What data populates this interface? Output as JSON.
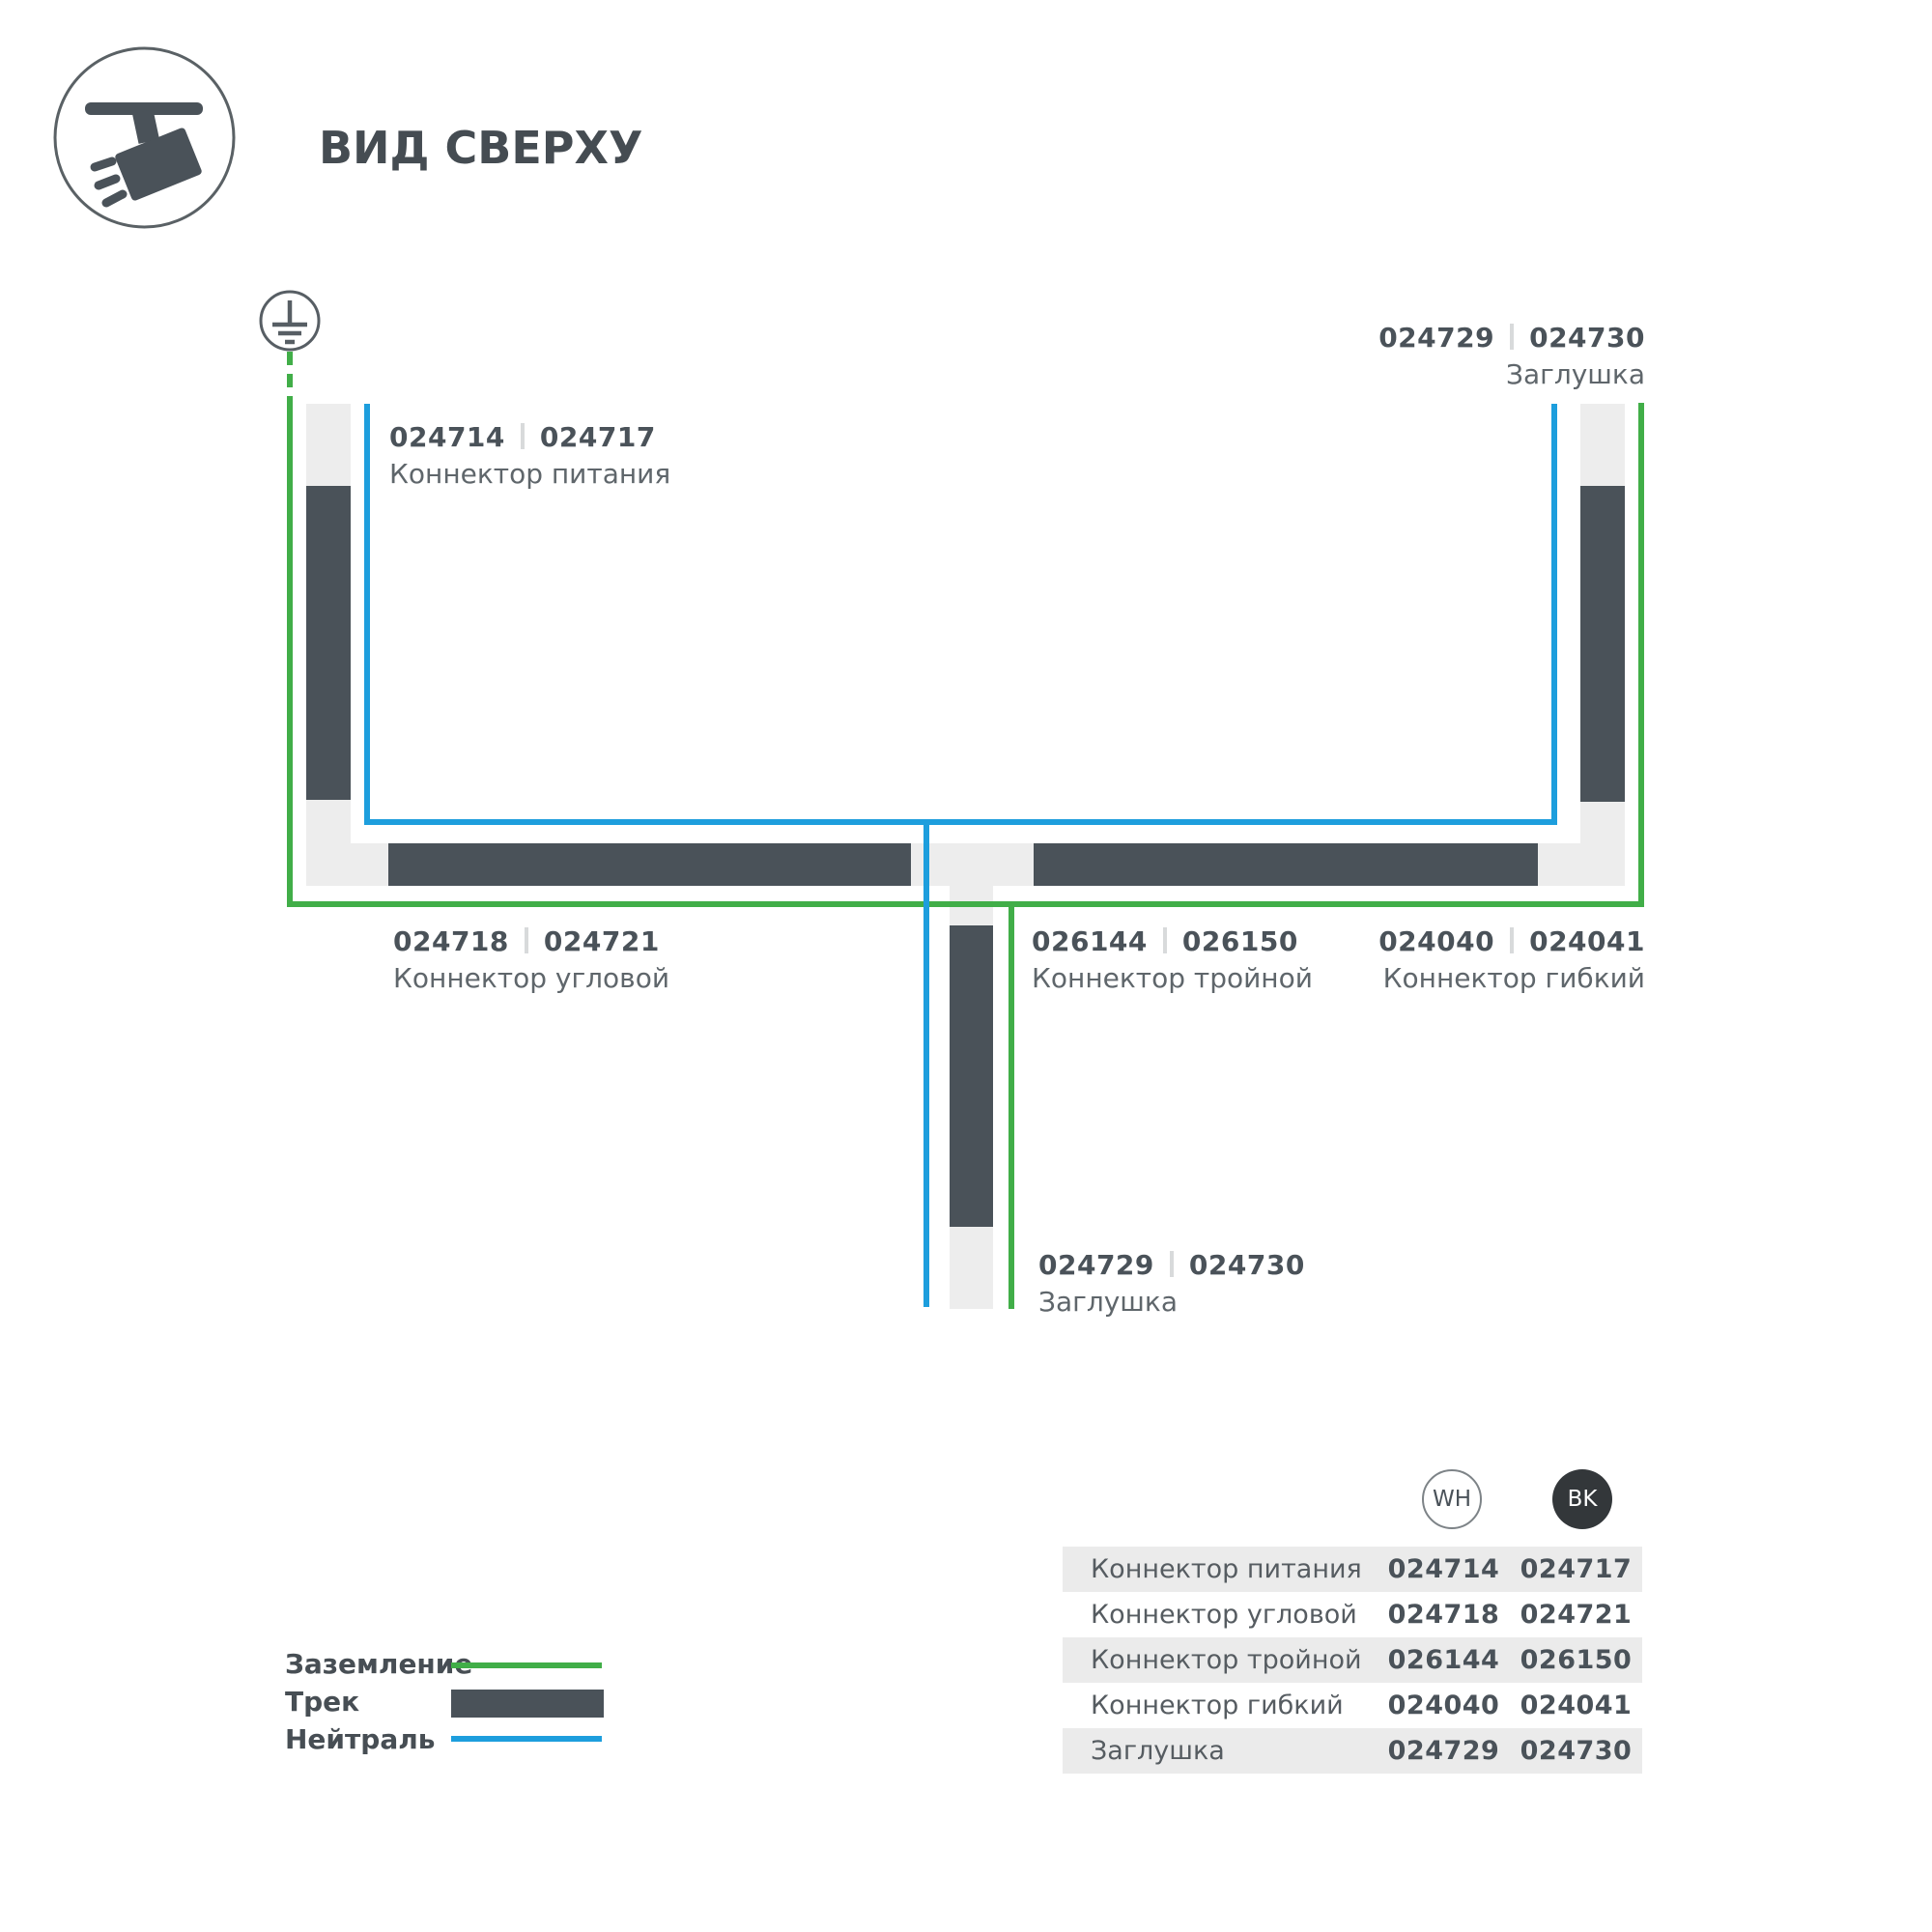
{
  "title": "ВИД СВЕРХУ",
  "colors": {
    "ground-green": "#41ae48",
    "neutral-blue": "#1d9edd",
    "track-dark": "#4a5259",
    "track-light": "#ededed",
    "table-row-gray": "#ebebeb",
    "bk-badge": "#33373a",
    "text-secondary": "#5f666b"
  },
  "connector_labels": {
    "power": {
      "wh": "024714",
      "bk": "024717",
      "name": "Коннектор питания"
    },
    "cap_top": {
      "wh": "024729",
      "bk": "024730",
      "name": "Заглушка"
    },
    "corner": {
      "wh": "024718",
      "bk": "024721",
      "name": "Коннектор угловой"
    },
    "triple": {
      "wh": "026144",
      "bk": "026150",
      "name": "Коннектор тройной"
    },
    "flex": {
      "wh": "024040",
      "bk": "024041",
      "name": "Коннектор гибкий"
    },
    "cap_bottom": {
      "wh": "024729",
      "bk": "024730",
      "name": "Заглушка"
    }
  },
  "legend": {
    "items": [
      {
        "label": "Заземление",
        "type": "ground-line"
      },
      {
        "label": "Трек",
        "type": "track-bar"
      },
      {
        "label": "Нейтраль",
        "type": "neutral-line"
      }
    ]
  },
  "table": {
    "header": {
      "wh": "WH",
      "bk": "BK"
    },
    "rows": [
      {
        "name": "Коннектор питания",
        "wh": "024714",
        "bk": "024717"
      },
      {
        "name": "Коннектор угловой",
        "wh": "024718",
        "bk": "024721"
      },
      {
        "name": "Коннектор тройной",
        "wh": "026144",
        "bk": "026150"
      },
      {
        "name": "Коннектор гибкий",
        "wh": "024040",
        "bk": "024041"
      },
      {
        "name": "Заглушка",
        "wh": "024729",
        "bk": "024730"
      }
    ]
  }
}
